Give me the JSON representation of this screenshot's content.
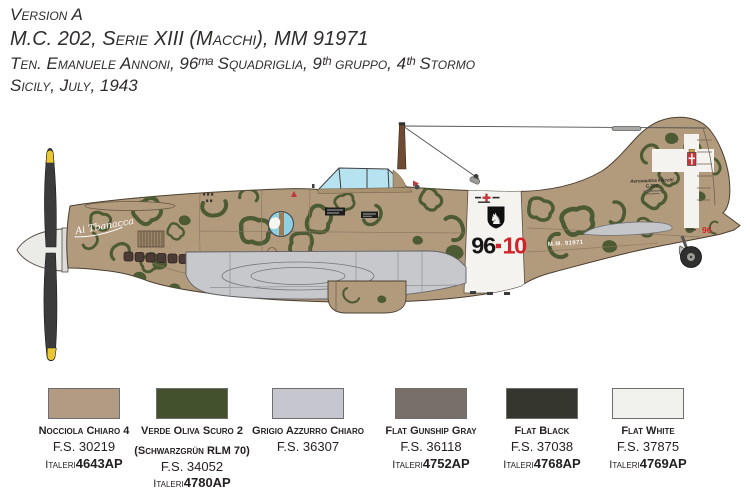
{
  "header": {
    "line1": "Version A",
    "line2": "M.C. 202, Serie XIII (Macchi), MM 91971",
    "line3": "Ten. Emanuele Annoni, 96ᵐᵃ Squadriglia, 9ᵗʰ gruppo, 4ᵗʰ Stormo",
    "line4": "Sicily, July, 1943"
  },
  "aircraft": {
    "nose_script": "Ai Tbanacca",
    "fuselage_code_group": "96",
    "fuselage_code_individual": "10",
    "serial_stencil": "M.M. 91971",
    "tail_stencil_line1": "Aeronautica Macchi",
    "tail_stencil_line2": "C.202",
    "tail_code": "96",
    "horse_emblem_glyph": "♞",
    "colors": {
      "base_tan": "#b29a7d",
      "mottle_green": "#4c5b33",
      "wing_gray": "#c7c8cb",
      "canopy_blue": "#b7e3f1",
      "band_white": "#f4f3ef",
      "code_red": "#d2232a",
      "code_black": "#161616",
      "prop_yellow": "#e9c733"
    }
  },
  "swatches": [
    {
      "name": "Nocciola Chiaro 4",
      "name2": "",
      "fs": "F.S. 30219",
      "brand": "Italeri",
      "code": "4643AP",
      "color": "#b29a83"
    },
    {
      "name": "Verde Oliva Scuro 2",
      "name2": "(Schwarzgrün RLM 70)",
      "fs": "F.S. 34052",
      "brand": "Italeri",
      "code": "4780AP",
      "color": "#44512d"
    },
    {
      "name": "Grigio Azzurro Chiaro",
      "name2": "",
      "fs": "F.S. 36307",
      "brand": "",
      "code": "",
      "color": "#c5c6ce"
    },
    {
      "name": "Flat Gunship Gray",
      "name2": "",
      "fs": "F.S. 36118",
      "brand": "Italeri",
      "code": "4752AP",
      "color": "#786f68"
    },
    {
      "name": "Flat Black",
      "name2": "",
      "fs": "F.S. 37038",
      "brand": "Italeri",
      "code": "4768AP",
      "color": "#35372f"
    },
    {
      "name": "Flat White",
      "name2": "",
      "fs": "F.S. 37875",
      "brand": "Italeri",
      "code": "4769AP",
      "color": "#f1f1ee"
    }
  ]
}
